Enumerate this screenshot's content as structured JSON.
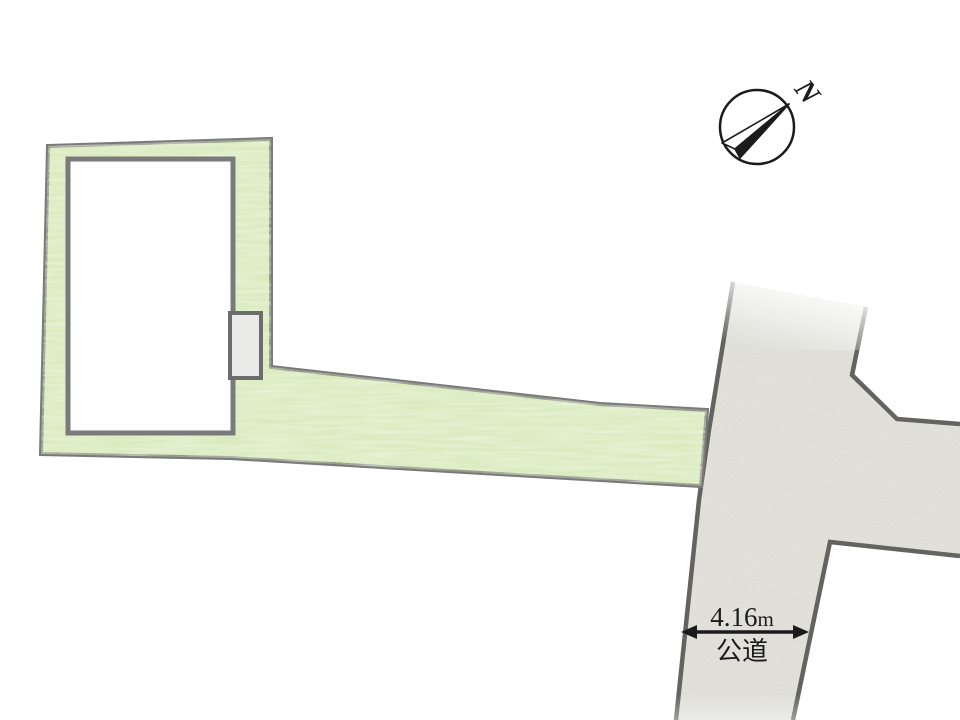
{
  "diagram": {
    "kind": "land-plot-layout"
  },
  "compass": {
    "north_label": "N"
  },
  "dimension": {
    "width_value": "4.16",
    "width_unit": "m"
  },
  "road": {
    "label": "公道"
  },
  "colors": {
    "background": "#ffffff",
    "parcel_green": "#dcecc2",
    "road_gray": "#e9e9e3",
    "outline_gray": "#7a7a7a",
    "road_edge_gray": "#63635f",
    "building_fill": "#ffffff",
    "structure_fill": "#e9e9e7",
    "structure_edge": "#6c6c6c",
    "ink": "#1b1b1b"
  }
}
